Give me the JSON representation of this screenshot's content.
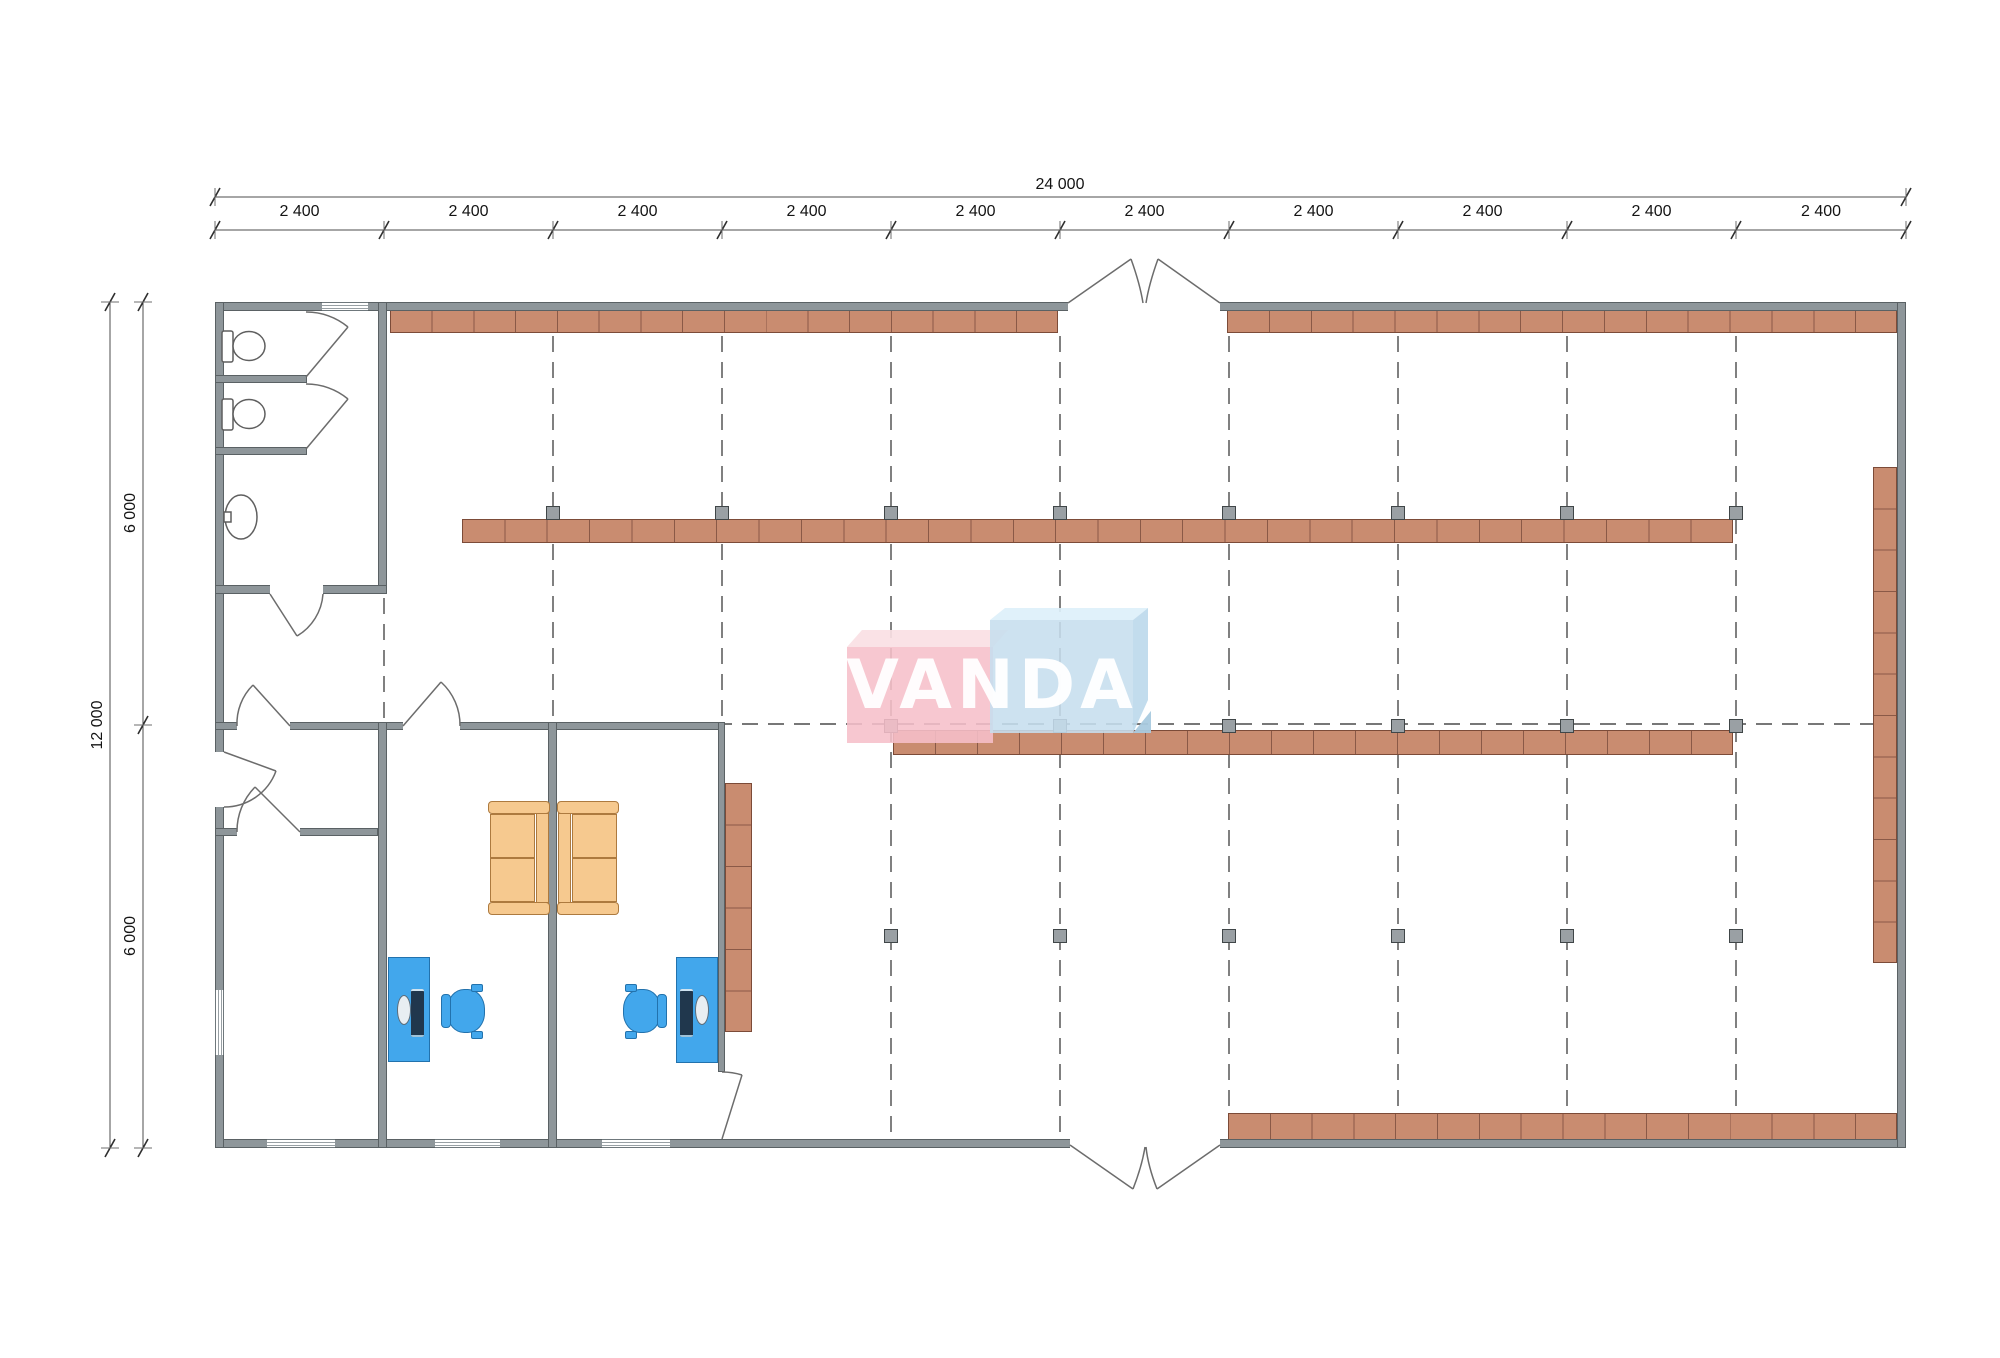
{
  "page": {
    "title": "VANDA retail building floor plan"
  },
  "watermark": {
    "text": "VANDA"
  },
  "dimensions": {
    "overall_width": "24 000",
    "bay": "2 400",
    "bay_count": 10,
    "overall_height": "12 000",
    "half_height": "6 000"
  },
  "plan": {
    "grid_x": [
      215,
      384,
      553,
      722,
      891,
      1060,
      1229,
      1398,
      1567,
      1736,
      1906
    ],
    "building": {
      "left": 215,
      "top": 302,
      "right": 1906,
      "bottom": 1148,
      "wall_thickness": 9
    },
    "dim_lines": [
      {
        "name": "overall-width-line",
        "x1": 215,
        "y1": 197,
        "x2": 1906,
        "y2": 197
      },
      {
        "name": "bay-line",
        "x1": 215,
        "y1": 230,
        "x2": 1906,
        "y2": 230
      },
      {
        "name": "overall-height-line",
        "x1": 110,
        "y1": 302,
        "x2": 110,
        "y2": 1148
      },
      {
        "name": "half-height-line",
        "x1": 143,
        "y1": 302,
        "x2": 143,
        "y2": 1148
      }
    ],
    "half_height_ticks_y": [
      302,
      725,
      1148
    ],
    "dashed_vertical": [
      {
        "x": 384,
        "y1": 598,
        "y2": 718
      },
      {
        "x": 553,
        "y1": 336,
        "y2": 718
      },
      {
        "x": 722,
        "y1": 336,
        "y2": 718
      },
      {
        "x": 891,
        "y1": 336,
        "y2": 1135
      },
      {
        "x": 1060,
        "y1": 336,
        "y2": 1135
      },
      {
        "x": 1229,
        "y1": 336,
        "y2": 1135
      },
      {
        "x": 1398,
        "y1": 336,
        "y2": 1135
      },
      {
        "x": 1567,
        "y1": 336,
        "y2": 1135
      },
      {
        "x": 1736,
        "y1": 336,
        "y2": 1135
      }
    ],
    "dashed_horizontal": {
      "y": 724,
      "x1": 222,
      "x2": 1895
    },
    "shelves": [
      {
        "name": "shelf-top-left",
        "x": 390,
        "y": 310,
        "w": 668,
        "h": 23,
        "cells": 16,
        "dir": "h"
      },
      {
        "name": "shelf-top-right",
        "x": 1227,
        "y": 310,
        "w": 670,
        "h": 23,
        "cells": 16,
        "dir": "h"
      },
      {
        "name": "shelf-middle-upper",
        "x": 462,
        "y": 519,
        "w": 1271,
        "h": 24,
        "cells": 30,
        "dir": "h"
      },
      {
        "name": "shelf-middle-lower",
        "x": 893,
        "y": 730,
        "w": 840,
        "h": 25,
        "cells": 20,
        "dir": "h"
      },
      {
        "name": "shelf-bottom",
        "x": 1228,
        "y": 1113,
        "w": 669,
        "h": 27,
        "cells": 16,
        "dir": "h"
      },
      {
        "name": "shelf-right-wall",
        "x": 1873,
        "y": 467,
        "w": 24,
        "h": 496,
        "cells": 12,
        "dir": "v"
      },
      {
        "name": "office-cabinet",
        "x": 725,
        "y": 783,
        "w": 27,
        "h": 249,
        "cells": 6,
        "dir": "v"
      }
    ],
    "columns": {
      "size": 14,
      "rows": [
        {
          "y": 513,
          "x": [
            553,
            722,
            891,
            1060,
            1229,
            1398,
            1567,
            1736
          ]
        },
        {
          "y": 726,
          "x": [
            891,
            1060,
            1229,
            1398,
            1567,
            1736
          ]
        },
        {
          "y": 936,
          "x": [
            891,
            1060,
            1229,
            1398,
            1567,
            1736
          ]
        }
      ]
    }
  },
  "colors": {
    "shelf": "#c98c70",
    "shelf_border": "#7c4b38",
    "shelf_line": "#8a5947",
    "wall": "#8e969a",
    "wall_border": "#5a6164",
    "column": "#9aa0a4",
    "column_border": "#404648",
    "desk": "#42a7ec",
    "desk_border": "#2272ad",
    "sofa": "#f6c98f",
    "sofa_border": "#ad7a3f",
    "logo_pink": "rgba(246,191,202,0.88)",
    "logo_pink_top": "rgba(250,223,228,0.92)",
    "logo_blue": "rgba(198,222,238,0.88)",
    "logo_blue_top": "rgba(221,240,250,0.92)",
    "logo_blue_side": "rgba(185,215,234,0.88)",
    "logo_blue_fold": "rgba(169,202,223,0.95)"
  }
}
